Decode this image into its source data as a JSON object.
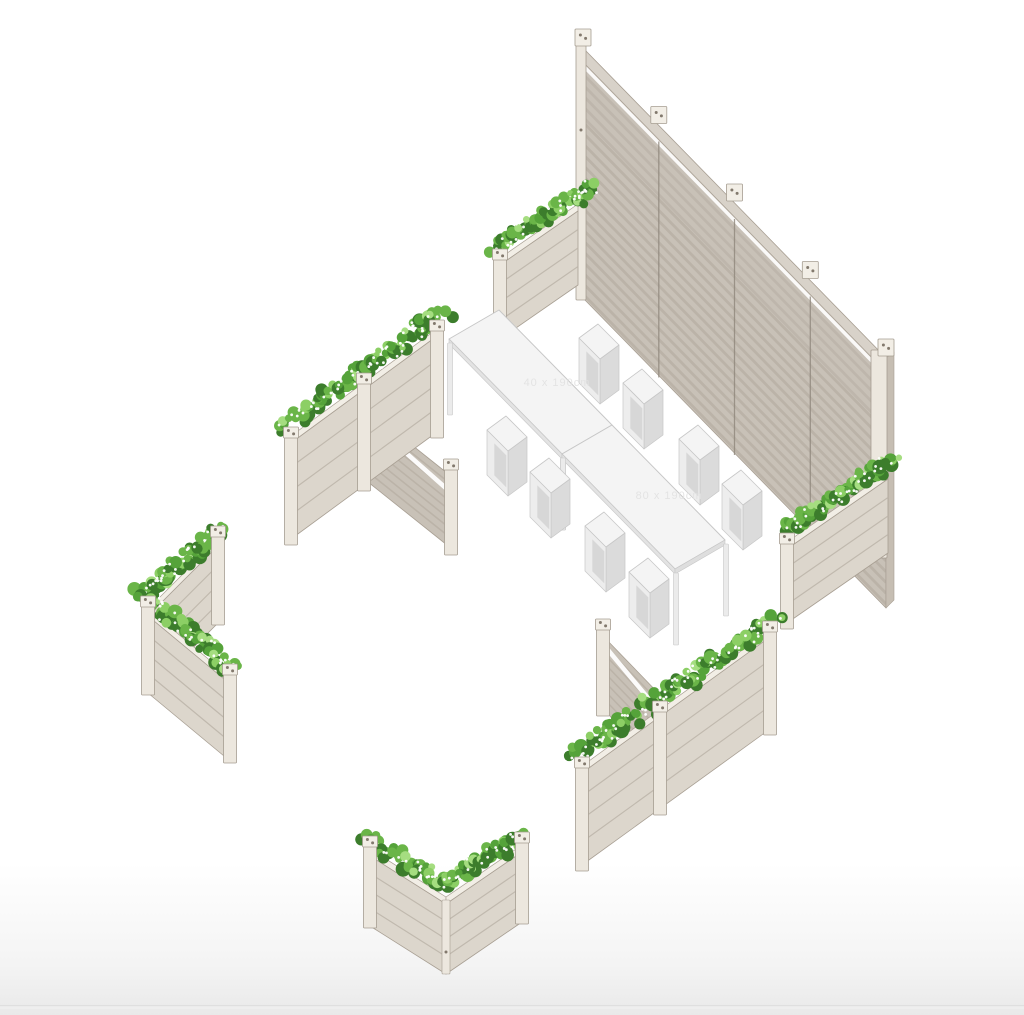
{
  "scene": {
    "alt": "Isometric 3D rendering of an outdoor seating area: a tall slatted privacy wall, flower planter boxes arranged around the space, two rectangular tables and eight cube stools",
    "background": {
      "top": "#ffffff",
      "bottom": "#e9e9e9",
      "floor_line": "#dddddd"
    },
    "palette": {
      "wall_face": "#c8c1b7",
      "wall_slat": "#b1a89d",
      "wall_divider": "#8f877c",
      "rail_face": "#d8d2c9",
      "planter_face": "#dcd6cc",
      "planter_slat": "#bcb4a9",
      "planter_side": "#c6beb3",
      "rim": "#f2eee6",
      "post_light": "#ece7de",
      "post_stroke": "#a59d91",
      "outline": "#a89f93",
      "screw": "#82796d",
      "greens": [
        "#3c7d2c",
        "#55a33a",
        "#6ab548",
        "#8ccf65",
        "#a5dd80"
      ],
      "flower": "#ffffff",
      "furniture_top": "#f4f4f4",
      "furniture_front": "#ededed",
      "furniture_side": "#dbdbdb",
      "furniture_inner": "#d4d4d4",
      "furniture_stroke": "#c7c7c7",
      "furniture_leg": "#ebebeb"
    },
    "watermarks": {
      "table1": "40 x 190cm",
      "table2": "80 x 190cm"
    },
    "objects": [
      {
        "id": "wall",
        "kind": "wall",
        "name": "privacy-wall",
        "label": "Slatted privacy wall (4 panels)"
      },
      {
        "id": "p1",
        "kind": "planter",
        "name": "planter-north",
        "label": "Flower planter at wall left end"
      },
      {
        "id": "p3",
        "kind": "planter",
        "name": "planter-east",
        "label": "Flower planter at wall right end"
      },
      {
        "id": "sb1",
        "kind": "stool",
        "name": "stool-back-1",
        "label": "Cube stool"
      },
      {
        "id": "sb2",
        "kind": "stool",
        "name": "stool-back-2",
        "label": "Cube stool"
      },
      {
        "id": "sb3",
        "kind": "stool",
        "name": "stool-back-3",
        "label": "Cube stool"
      },
      {
        "id": "sb4",
        "kind": "stool",
        "name": "stool-back-4",
        "label": "Cube stool"
      },
      {
        "id": "t1",
        "kind": "table",
        "name": "table-1",
        "label": "Rectangular table"
      },
      {
        "id": "t2",
        "kind": "table",
        "name": "table-2",
        "label": "Rectangular table"
      },
      {
        "id": "sf1",
        "kind": "stool",
        "name": "stool-front-1",
        "label": "Cube stool"
      },
      {
        "id": "sf2",
        "kind": "stool",
        "name": "stool-front-2",
        "label": "Cube stool"
      },
      {
        "id": "sf3",
        "kind": "stool",
        "name": "stool-front-3",
        "label": "Cube stool"
      },
      {
        "id": "sf4",
        "kind": "stool",
        "name": "stool-front-4",
        "label": "Cube stool"
      },
      {
        "id": "p2",
        "kind": "planter-screen",
        "name": "planter-row-west",
        "label": "Planter row with privacy screen"
      },
      {
        "id": "p4",
        "kind": "planter-screen",
        "name": "planter-row-south",
        "label": "Planter row with privacy screen"
      },
      {
        "id": "p5",
        "kind": "corner",
        "name": "corner-planter-west",
        "label": "Corner planter (chevron)"
      },
      {
        "id": "p6",
        "kind": "corner",
        "name": "corner-planter-south",
        "label": "Corner planter (V)"
      }
    ]
  }
}
